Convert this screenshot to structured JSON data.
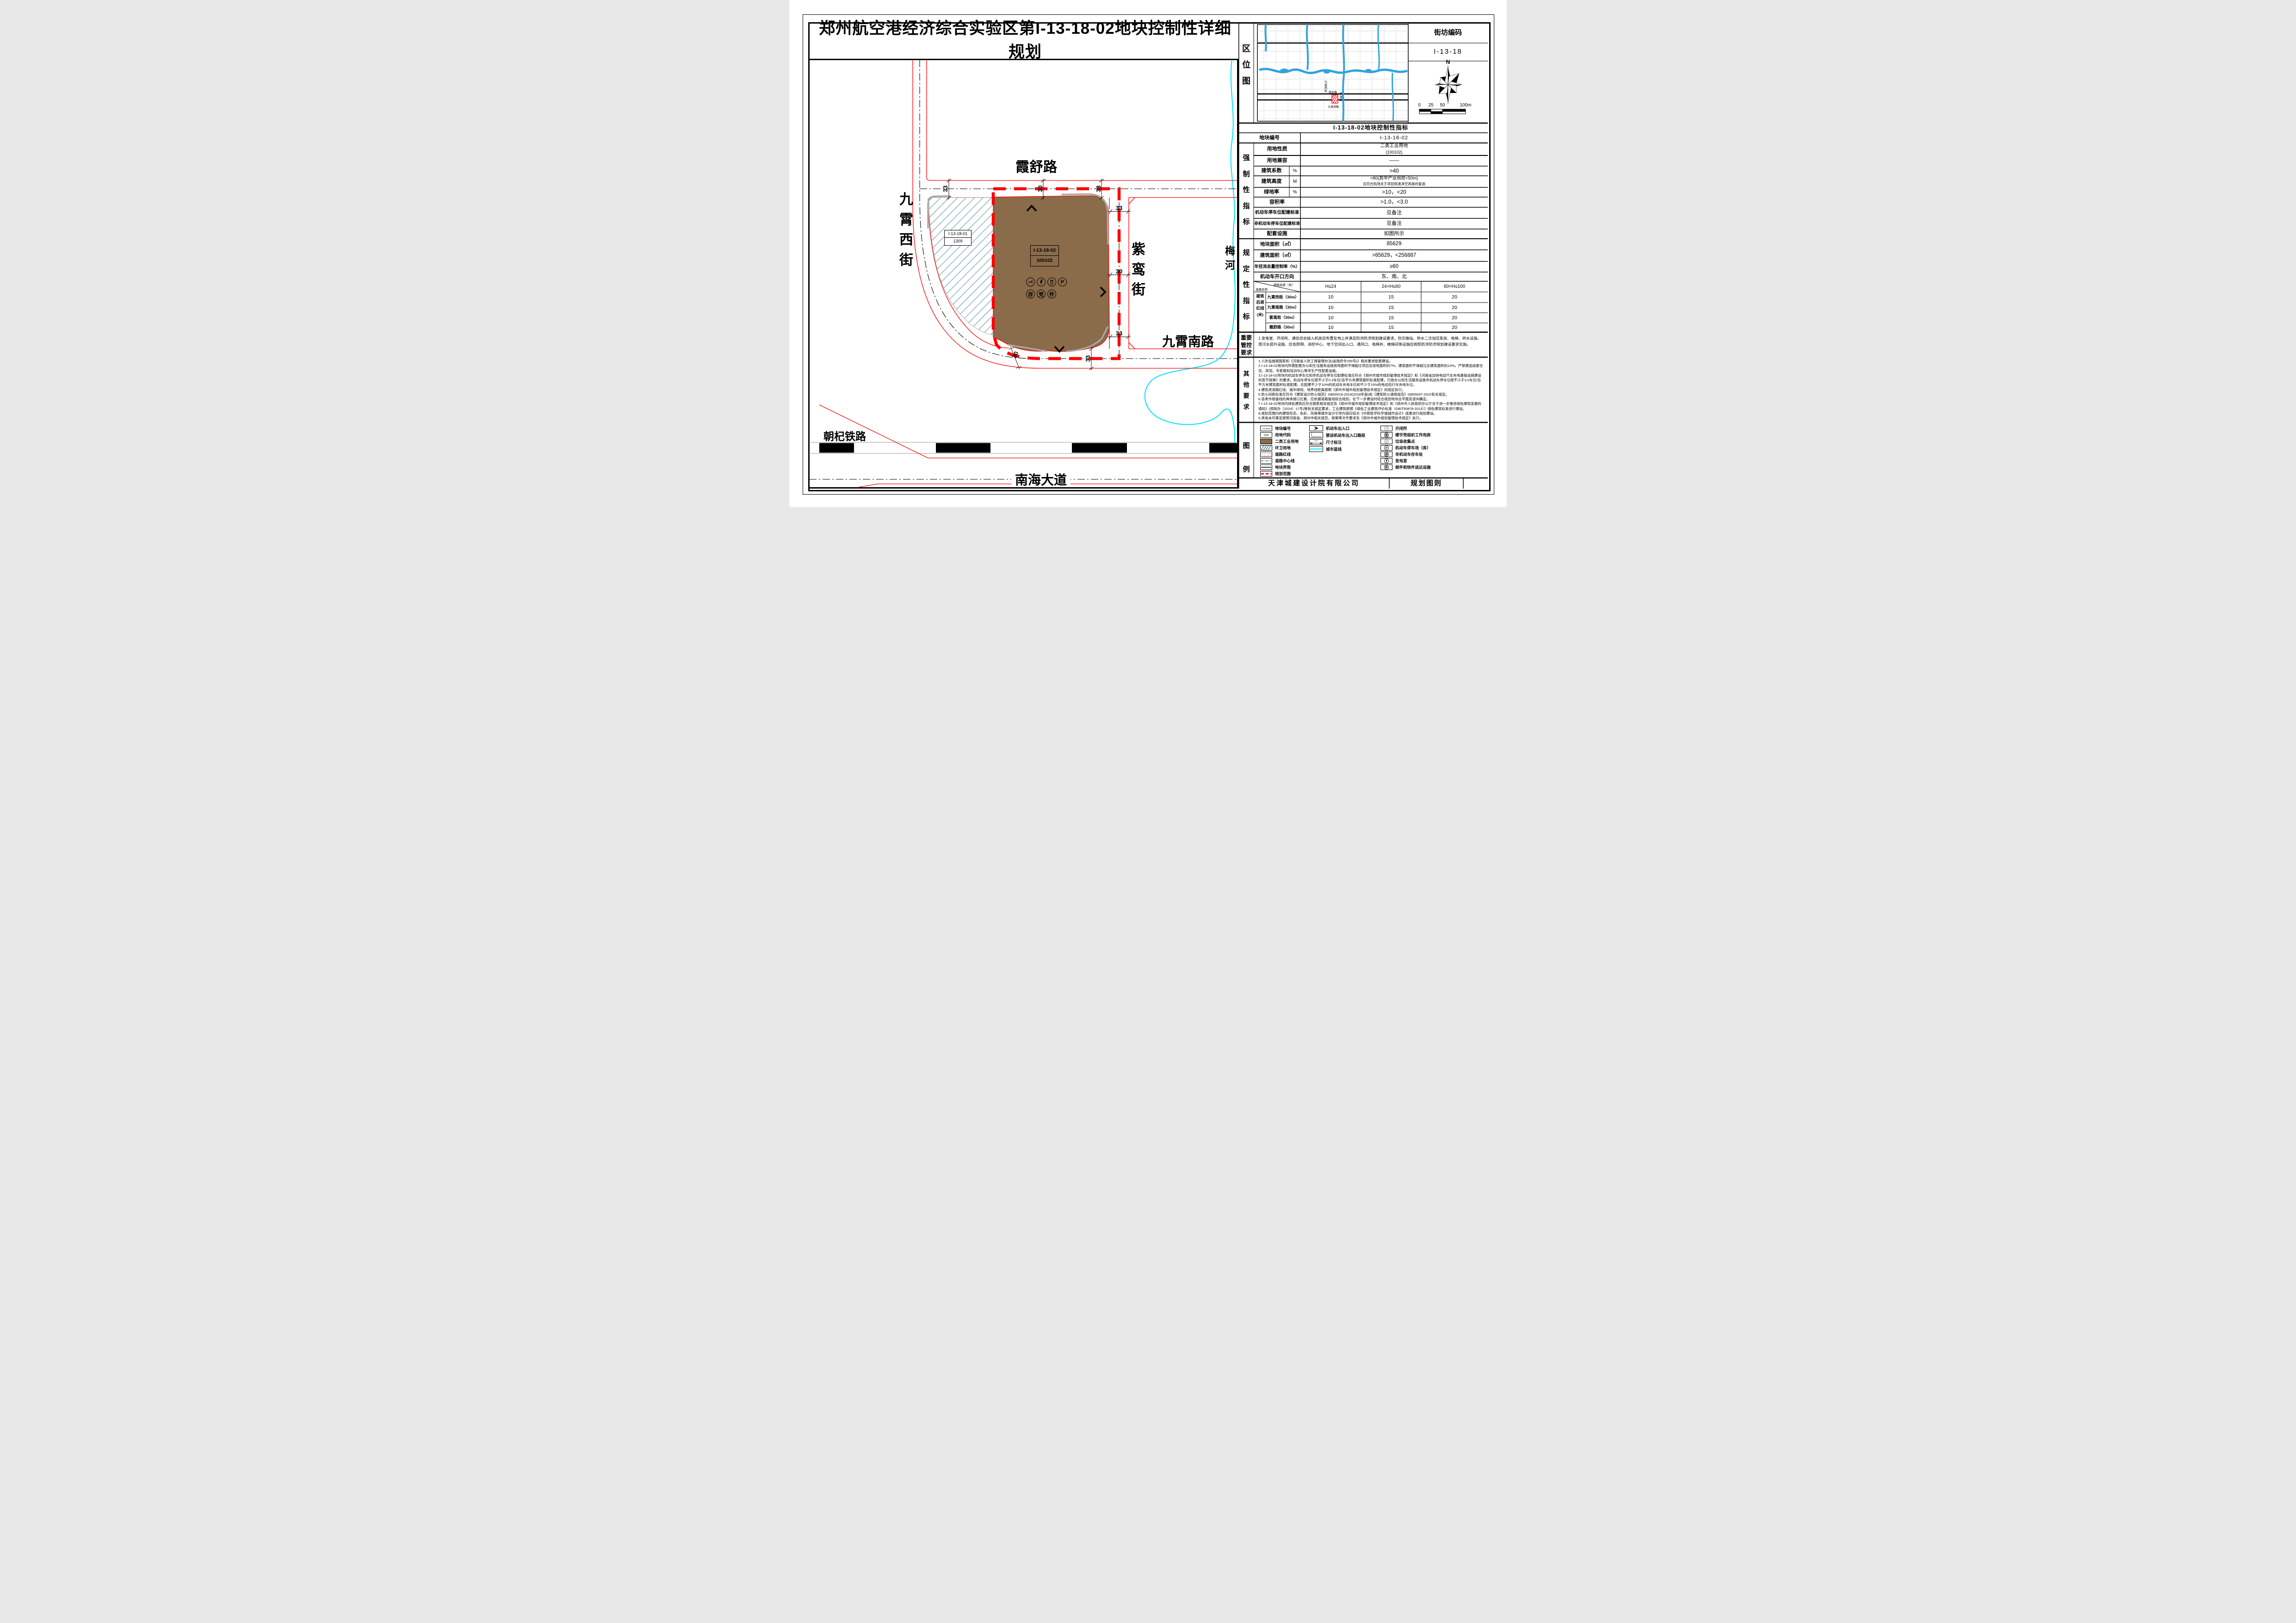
{
  "title": "郑州航空港经济综合实验区第I-13-18-02地块控制性详细规划",
  "location_map": {
    "label": "区\n位\n图",
    "streets": {
      "jiuxiaoxi": "九\n霄\n西\n街",
      "xiashu": "霞舒路",
      "ziluan": "紫\n鸾\n街",
      "jiuxiaonan": "九霄南路"
    }
  },
  "block_code": {
    "label": "街坊编码",
    "value": "I-13-18"
  },
  "compass": {
    "north": "N"
  },
  "scale_bar": {
    "t0": "0",
    "t25": "25",
    "t50": "50",
    "t100": "100m"
  },
  "map": {
    "roads": {
      "xiashu": "霞舒路",
      "jiuxiaoxi": "九\n霄\n西\n街",
      "ziluan": "紫\n鸾\n街",
      "jiuxiaonan": "九霄南路",
      "nanhai": "南海大道",
      "chaoqi": "朝杞铁路",
      "meihe": "梅\n河"
    },
    "dims": {
      "d30": "30",
      "d33": "33"
    },
    "parcel_main": {
      "line1": "I-13-18-02",
      "line2": "100102"
    },
    "parcel_west": {
      "line1": "I-13-18-01",
      "line2": "1309"
    },
    "icons": {
      "p": "P",
      "cun": "存",
      "dang": "党",
      "jian": "件"
    }
  },
  "indicators": {
    "title": "I-13-18-02地块控制性指标",
    "parcel_no_label": "地块编号",
    "parcel_no": "I-13-18-02",
    "group_mandatory": "强\n制\n性\n指\n标",
    "land_use_label": "用地性质",
    "land_use": "二类工业用地",
    "land_use_code": "(100102)",
    "compat_label": "用地兼容",
    "compat": "——",
    "bld_coeff_label": "建筑系数",
    "bld_coeff_unit": "%",
    "bld_coeff": ">40",
    "height_label": "建筑高度",
    "height_unit": "M",
    "height": "<80(其中产业用房<50m)",
    "height_note": "且符合机场关于项目核准净空高度的复函",
    "green_label": "绿地率",
    "green_unit": "%",
    "green": ">10，<20",
    "far_label": "容积率",
    "far": ">1.0，<3.0",
    "parking_label": "机动车停车位配建标准",
    "parking": "见备注",
    "nonmotor_label": "非机动车停车位配建标准",
    "nonmotor": "见备注",
    "facilities_label": "配套设施",
    "facilities": "如图所示",
    "group_prescriptive": "规\n定\n性\n指\n标",
    "area_label": "地块面积（㎡）",
    "area": "85629",
    "floor_area_label": "建筑面积（㎡）",
    "floor_area": ">85629，<256887",
    "runoff_label": "年径流总量控制率（%）",
    "runoff": "≥60",
    "access_label": "机动车开口方向",
    "access": "东、南、北"
  },
  "setback": {
    "group_label": "建筑\n后退\n红线\n(米)",
    "diag_top": "建筑高度（米）",
    "diag_bottom": "道路名称",
    "col1": "H≤24",
    "col2": "24<H≤60",
    "col3": "60<H≤100",
    "rows": [
      {
        "road": "九霄西街（30m）",
        "v1": "10",
        "v2": "15",
        "v3": "20"
      },
      {
        "road": "九霄南路（30m）",
        "v1": "10",
        "v2": "15",
        "v3": "20"
      },
      {
        "road": "紫鸾街（30m）",
        "v1": "10",
        "v2": "15",
        "v3": "20"
      },
      {
        "road": "霞舒路（30m）",
        "v1": "10",
        "v2": "15",
        "v3": "20"
      }
    ]
  },
  "important": {
    "label": "重要\n管控\n要求",
    "text": "1.变电室、开闭所、通信综合接入机房应布置在地上并满足防洪防涝规划建设要求。热交换站、供水二次加压泵房、电梯、供水设施、雨污水提升设施、应急照明、消控中心、地下空间出入口、通风口、电梯井、楼梯间等设施应按照防洪防涝规划建设要求实施。"
  },
  "other": {
    "label": "其\n他\n要\n求",
    "items": [
      "1.人防设施按国家和《河南省人防工程管理办法(省政府令200号)》相关要求配套建设。",
      "2.I-13-18-02地块内所需配套办公和生活服务设施用地面积不得超过项目总用地面积的7%，建筑面积不得超过总建筑面积的15%。严禁建造成套住宅、宾馆、专家楼和培训中心等非生产性配套设施。",
      "3.I-13-18-02地块内机动车停车位和非机动车停车位配建标准应符合《郑州市城市规划管理技术规定》和《河南省加快电动汽车充电基础设施建设的若干政策》的要求。机动车停车位按不小于0.3车位/百平方米建筑面积标准配建，行政办公和生活服务设施非机动车停车位按不小于3.0车位/百平方米建筑面积标准配建。应配建不少于10%的机动车充电车位和不少于15%的电动自行车充电车位。",
      "4.建筑退道路红线、城市绿线、地界线距离按照《郑州市城市规划管理技术规定》的规定执行。",
      "5.防火间距标准应符合《建筑设计防火规范》GB50016-2014(2018年版)和《建筑防火通用规范》GB55037-2022有关规定。",
      "6.各类市政管线的具体接口位置，应依据道路管线综合规划，在下一步建设时结合规划地块总平面及竖向确定。",
      "7.I-13-18-02地块内绿色建筑应符合国家相关规范及《郑州市城市规划管理技术规定》和《郑州市人民政府办公厅关于进一步推进绿色建筑发展的通知》(郑政办〔2024〕17号)等有关规定要求，工业建筑按照《绿色工业建筑评价标准（GB/T50878-2013）》绿色建筑标准进行建设。",
      "8.规划范围内的建筑形态、色彩、风格等城市设计引导内容应结合《中原医学科学城城市设计》成果进行规划建设。",
      "9.其他未尽事宜按照河南省、郑州市相关规范、政策等文件要求及《郑州市城市规划管理技术规定》执行。"
    ]
  },
  "legend": {
    "label": "图\n例",
    "items": [
      "地块编号",
      "用地代码",
      "二类工业用地",
      "环卫用地",
      "道路红线",
      "道路中心线",
      "地块界限",
      "规划范围",
      "机动车出入口",
      "禁设机动车出入口路段",
      "尺寸标注",
      "城市蓝线",
      "开闭所",
      "楼宇党组织工作用房",
      "垃圾收集点",
      "机动车停车场（库）",
      "非机动车存车处",
      "变电室",
      "邮件和快件送达设施"
    ],
    "swatch_parcel_code": "I-13-18-02",
    "swatch_use_code": "1303",
    "swatch_dim": "30.0",
    "icon_dang": "党",
    "icon_cun": "存",
    "icon_jian": "件",
    "icon_p": "P"
  },
  "footer": {
    "company": "天津城建设计院有限公司",
    "sheet_name": "规划图则"
  },
  "colors": {
    "industrial": "#8a6b4a",
    "hatch": "#2a7080",
    "red_line": "#ff0000",
    "blue_line": "#00e1ff",
    "minimap_water": "#33a3dc"
  }
}
